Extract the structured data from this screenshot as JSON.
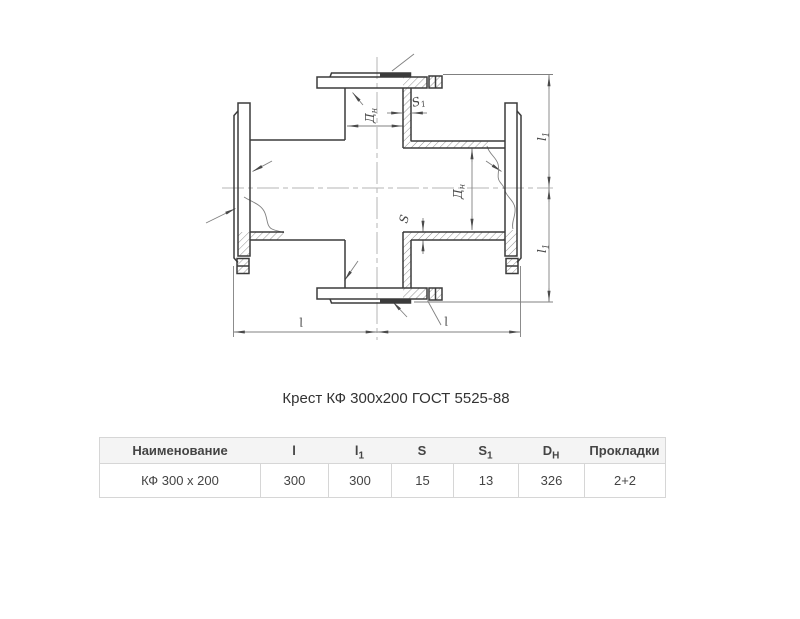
{
  "title": "Крест КФ 300x200 ГОСТ 5525-88",
  "drawing": {
    "labels": {
      "dn_branch": {
        "base": "Д",
        "sub": "н"
      },
      "dn_run": {
        "base": "Д",
        "sub": "н"
      },
      "s1": {
        "base": "S",
        "sub": "1"
      },
      "s": {
        "base": "S",
        "sub": ""
      },
      "l1_top": {
        "base": "l",
        "sub": "1"
      },
      "l1_bottom": {
        "base": "l",
        "sub": "1"
      },
      "l_left": {
        "base": "l",
        "sub": ""
      },
      "l_right": {
        "base": "l",
        "sub": ""
      }
    },
    "colors": {
      "outline": "#3b3b3b",
      "thin": "#808080",
      "centerline": "#b5b5b5"
    }
  },
  "table": {
    "header_bg": "#f4f4f4",
    "border_color": "#d6d6d6",
    "text_color": "#444444",
    "columns": [
      {
        "base": "Наименование",
        "sub": ""
      },
      {
        "base": "l",
        "sub": ""
      },
      {
        "base": "l",
        "sub": "1"
      },
      {
        "base": "S",
        "sub": ""
      },
      {
        "base": "S",
        "sub": "1"
      },
      {
        "base": "D",
        "sub": "H"
      },
      {
        "base": "Прокладки",
        "sub": ""
      }
    ],
    "rows": [
      [
        "КФ 300 x 200",
        "300",
        "300",
        "15",
        "13",
        "326",
        "2+2"
      ]
    ]
  }
}
